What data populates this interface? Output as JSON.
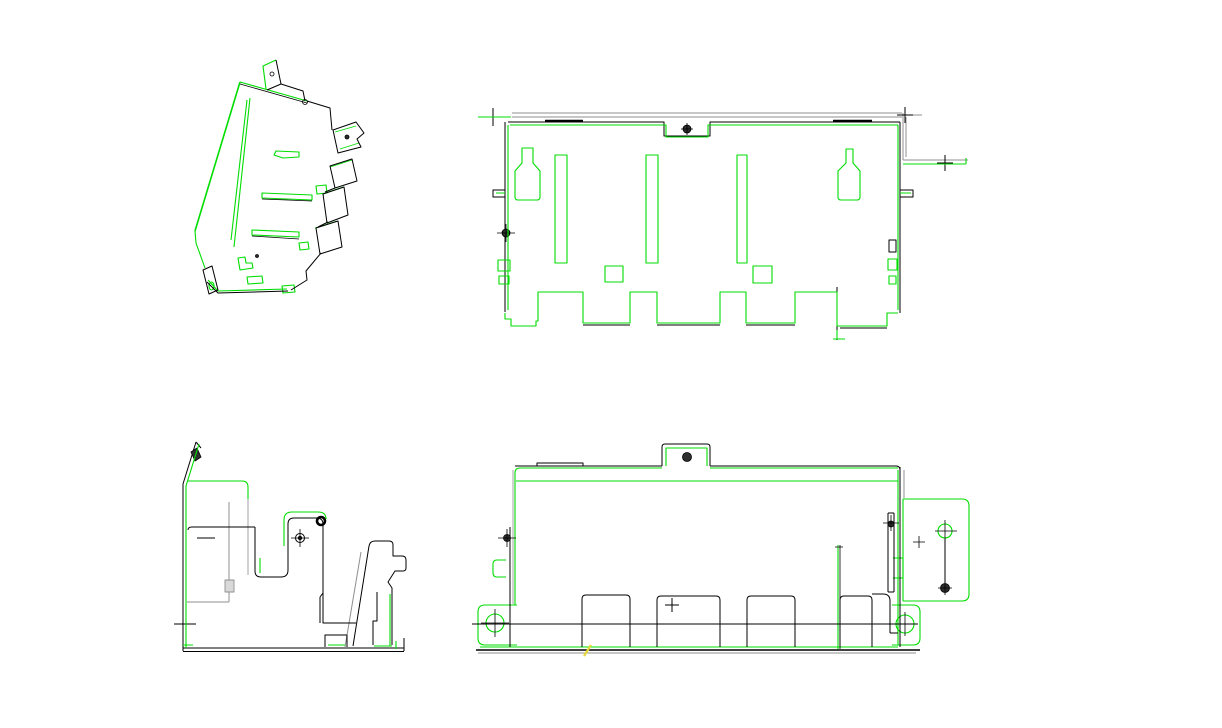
{
  "window": {
    "width": 1222,
    "height": 728,
    "background": "#ffffff"
  },
  "palette": {
    "line-green": "#00dd00",
    "line-black": "#000000",
    "line-gray": "#8f8f8f",
    "fill-dark": "#2f2f2f",
    "line-yellow": "#e8d93a",
    "canvas-bg": "#ffffff"
  },
  "drawing": {
    "kind": "multi-view wireframe CAD drawing of a sheet-metal bracket",
    "views": [
      {
        "id": "isometric",
        "label": "isometric projection view",
        "position": "top-left"
      },
      {
        "id": "top",
        "label": "top view",
        "position": "top-right"
      },
      {
        "id": "side",
        "label": "left side view",
        "position": "bottom-left"
      },
      {
        "id": "front",
        "label": "front view",
        "position": "bottom-right"
      }
    ],
    "canvas_label": "drawing canvas"
  }
}
